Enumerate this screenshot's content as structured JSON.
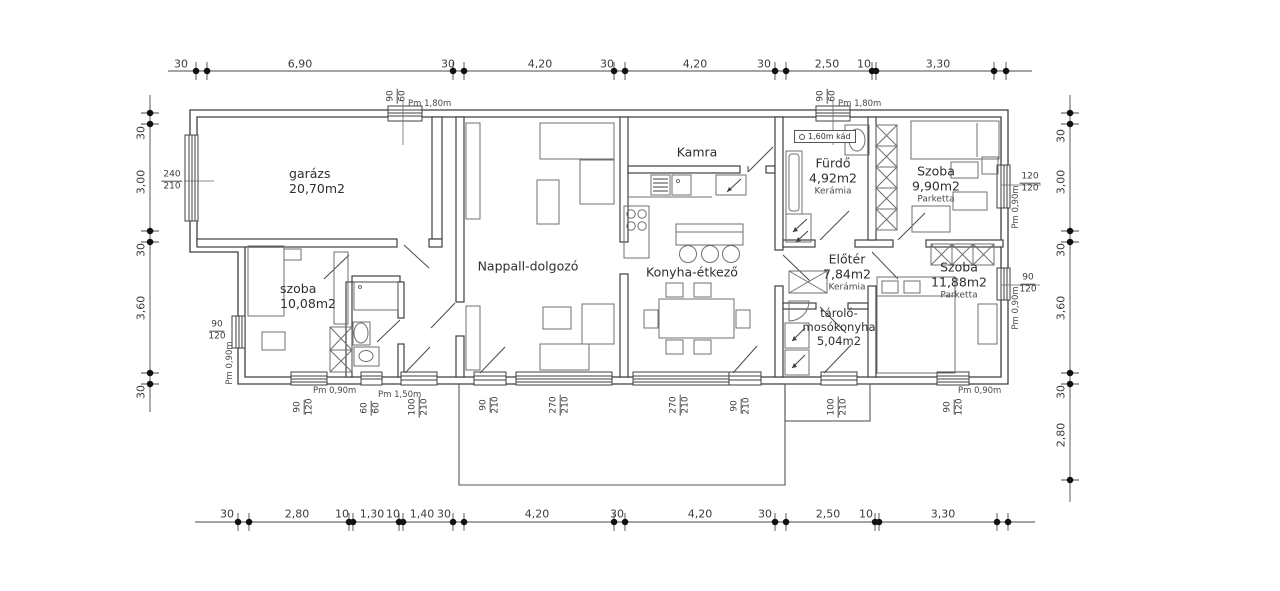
{
  "plan": {
    "rooms": {
      "garage": {
        "name": "garázs",
        "area": "20,70m2"
      },
      "bedroom_left": {
        "name": "szoba",
        "area": "10,08m2"
      },
      "living": {
        "name": "Nappall-dolgozó"
      },
      "pantry": {
        "name": "Kamra"
      },
      "kitchen": {
        "name": "Konyha-étkező"
      },
      "bathroom": {
        "name": "Fürdő",
        "area": "4,92m2",
        "floor": "Kerámia"
      },
      "bedroom_top_right": {
        "name": "Szoba",
        "area": "9,90m2",
        "floor": "Parketta"
      },
      "foyer": {
        "name": "Előtér",
        "area": "7,84m2",
        "floor": "Kerámia"
      },
      "laundry": {
        "name": "tároló-",
        "name2": "mosókonyha",
        "area": "5,04m2"
      },
      "bedroom_bottom_right": {
        "name": "Szoba",
        "area": "11,88m2",
        "floor": "Parketta"
      }
    },
    "fixtures": {
      "bathtub": "1,60m kád"
    },
    "dims": {
      "top": [
        "30",
        "6,90",
        "30",
        "4,20",
        "30",
        "4,20",
        "30",
        "2,50",
        "10",
        "3,30"
      ],
      "bottom": [
        "30",
        "2,80",
        "10",
        "1,30",
        "10",
        "1,40",
        "30",
        "4,20",
        "30",
        "4,20",
        "30",
        "2,50",
        "10",
        "3,30"
      ],
      "left": [
        "30",
        "3,00",
        "30",
        "3,60",
        "30"
      ],
      "right": [
        "30",
        "3,00",
        "30",
        "3,60",
        "30",
        "2,80"
      ]
    },
    "openings": {
      "top_garage": {
        "w": "90",
        "h": "60",
        "pm": "Pm 1,80m"
      },
      "top_bath": {
        "w": "90",
        "h": "60",
        "pm": "Pm 1,80m"
      },
      "left_garage_door": {
        "w": "240",
        "h": "210"
      },
      "left_bedroom_win": {
        "w": "90",
        "h": "120",
        "pm": "Pm 0,90m"
      },
      "b1": {
        "w": "90",
        "h": "120",
        "pm": "Pm 0,90m"
      },
      "b2": {
        "w": "60",
        "h": "60",
        "pm": "Pm 1,50m"
      },
      "b3": {
        "w": "100",
        "h": "210"
      },
      "b4": {
        "w": "90",
        "h": "210"
      },
      "b5": {
        "w": "270",
        "h": "210"
      },
      "b6": {
        "w": "270",
        "h": "210"
      },
      "b7": {
        "w": "90",
        "h": "210"
      },
      "b8": {
        "w": "100",
        "h": "210"
      },
      "b9": {
        "w": "90",
        "h": "120",
        "pm": "Pm 0,90m"
      },
      "r1": {
        "w": "120",
        "h": "120",
        "pm": "Pm 0,90m"
      },
      "r2": {
        "w": "90",
        "h": "120",
        "pm": "Pm 0,90m"
      }
    }
  }
}
